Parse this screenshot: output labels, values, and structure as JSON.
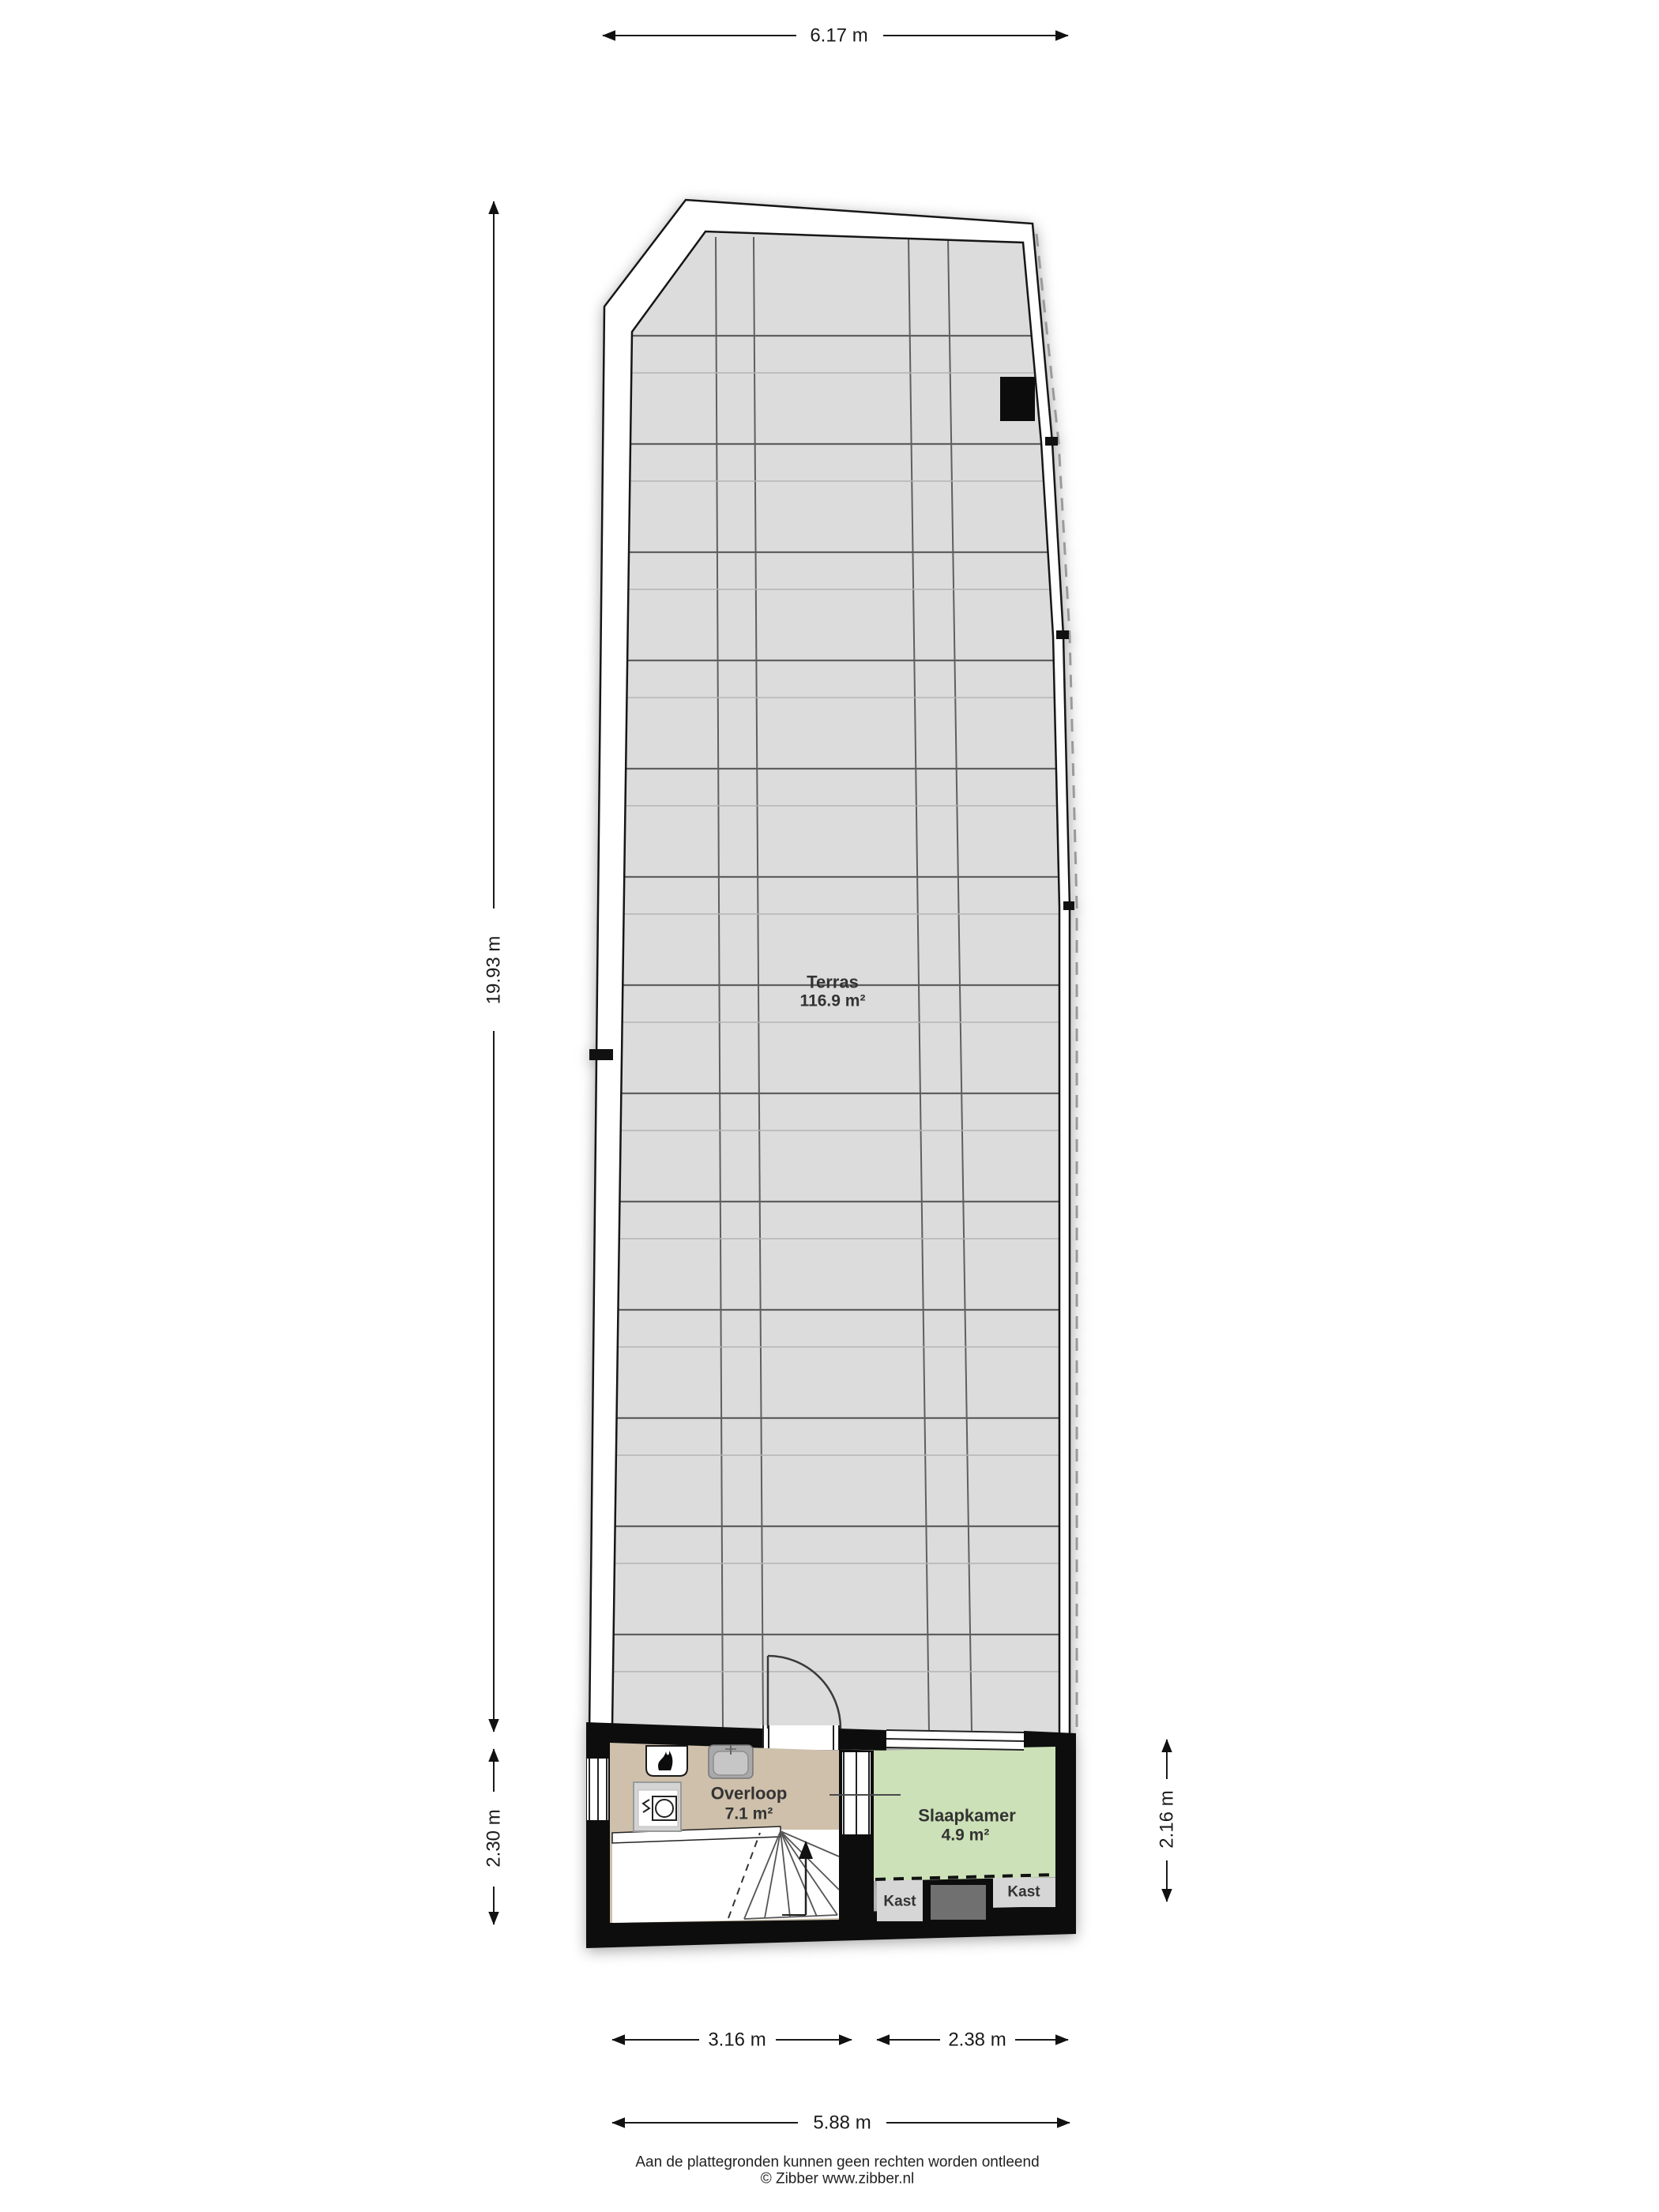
{
  "floorplan": {
    "rooms": [
      {
        "name": "Terras",
        "area": "116.9 m²"
      },
      {
        "name": "Overloop",
        "area": "7.1 m²"
      },
      {
        "name": "Slaapkamer",
        "area": "4.9 m²"
      }
    ],
    "closets": [
      {
        "label": "Kast"
      },
      {
        "label": "Kast"
      }
    ],
    "dimensions": {
      "top_width": "6.17 m",
      "terras_length": "19.93 m",
      "landing_depth": "2.30 m",
      "bedroom_depth": "2.16 m",
      "bottom_left_width": "3.16 m",
      "bottom_right_width": "2.38 m",
      "bottom_total_width": "5.88 m"
    },
    "footer": {
      "disclaimer": "Aan de plattegronden kunnen geen rechten worden ontleend",
      "credit": "© Zibber www.zibber.nl"
    },
    "colors": {
      "terras_floor": "#dcdcdc",
      "overloop_floor": "#cec0ab",
      "slaapkamer_floor": "#cde1b8",
      "kast_floor": "#d6d6d6",
      "duct_gray": "#707070",
      "wall_black": "#0d0d0d",
      "wall_white": "#ffffff",
      "grid_dark": "#5f5f5f",
      "grid_light": "#b3b3b3",
      "dim_color": "#1a1a1a",
      "label_color": "#333333"
    }
  }
}
